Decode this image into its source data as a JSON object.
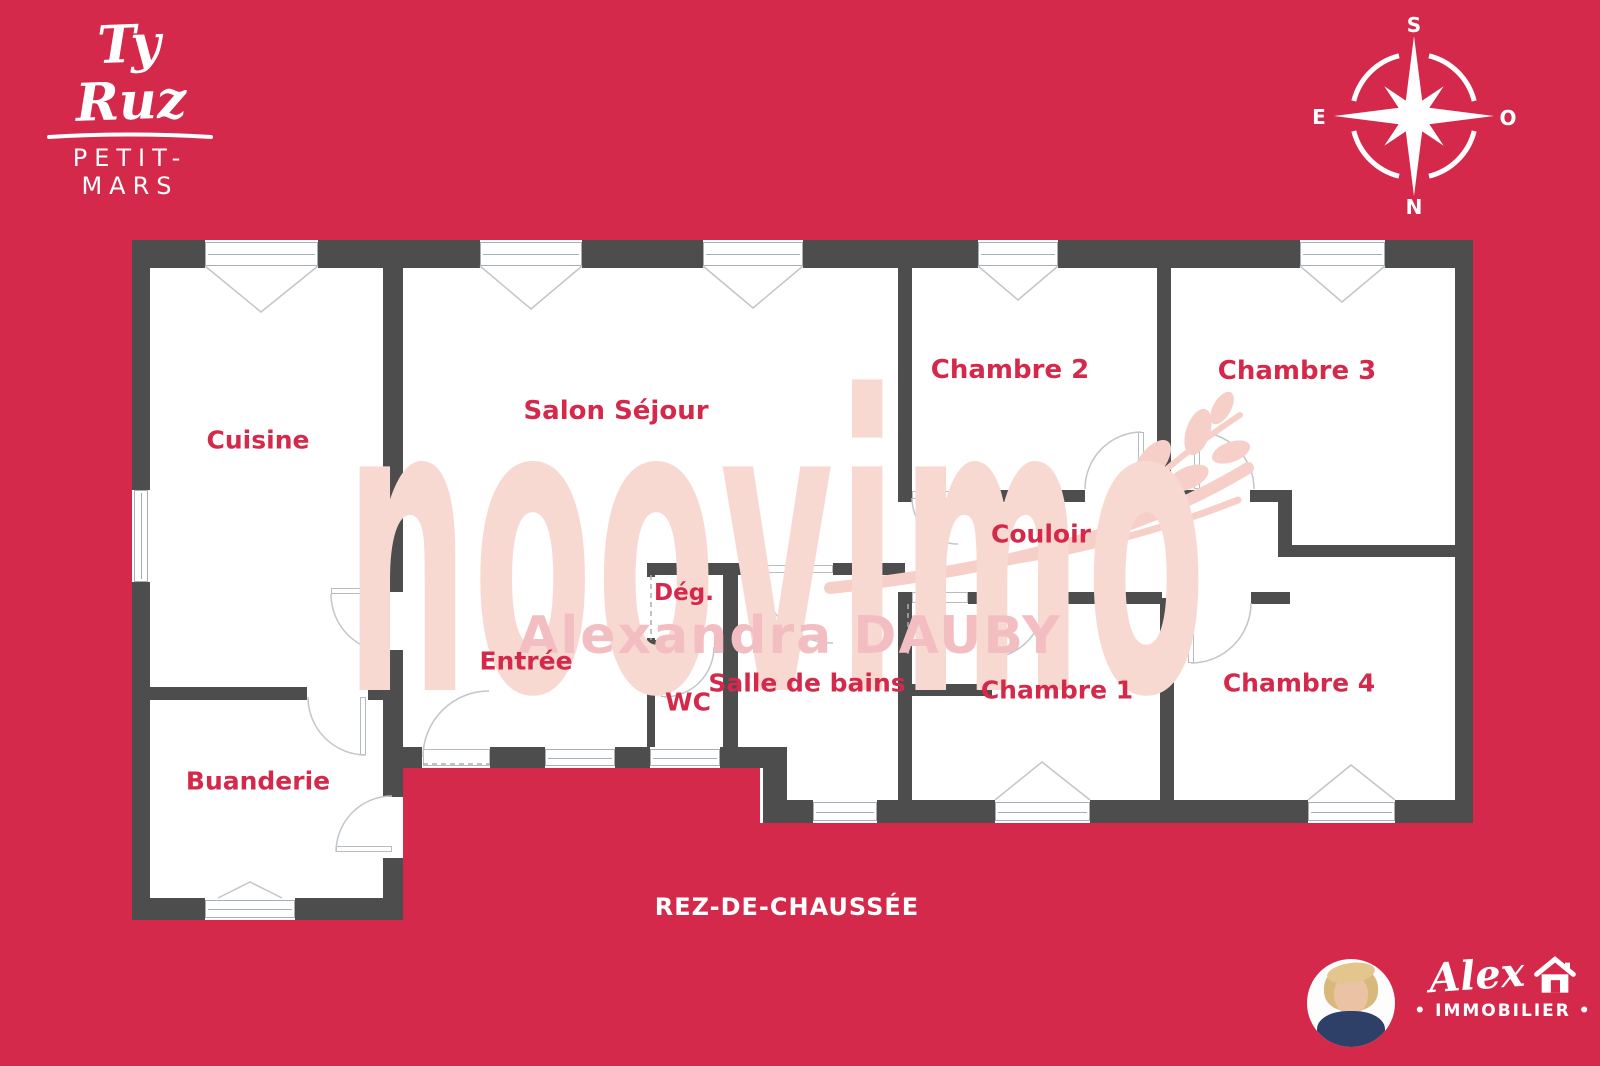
{
  "brand": {
    "name": "Ty Ruz",
    "location": "PETIT-MARS"
  },
  "compass": {
    "top": "S",
    "bottom": "N",
    "left": "E",
    "right": "O"
  },
  "plan": {
    "floor_label": "REZ-DE-CHAUSSÉE",
    "rooms": [
      {
        "name": "Cuisine"
      },
      {
        "name": "Salon Séjour"
      },
      {
        "name": "Chambre 2"
      },
      {
        "name": "Chambre 3"
      },
      {
        "name": "Couloir"
      },
      {
        "name": "Dég."
      },
      {
        "name": "Entrée"
      },
      {
        "name": "WC"
      },
      {
        "name": "Salle de bains"
      },
      {
        "name": "Chambre 1"
      },
      {
        "name": "Chambre 4"
      },
      {
        "name": "Buanderie"
      }
    ]
  },
  "watermark": {
    "brand": "noovimo",
    "agent": "Alexandra DAUBY"
  },
  "agency": {
    "script_name": "Alex",
    "subtitle": "• IMMOBILIER •"
  },
  "colors": {
    "background": "#d4294a",
    "wall": "#4d4d4d",
    "room_label": "#d4294a",
    "watermark_brand": "#f8d9d2",
    "watermark_agent": "#f2bec1",
    "text_white": "#ffffff"
  }
}
